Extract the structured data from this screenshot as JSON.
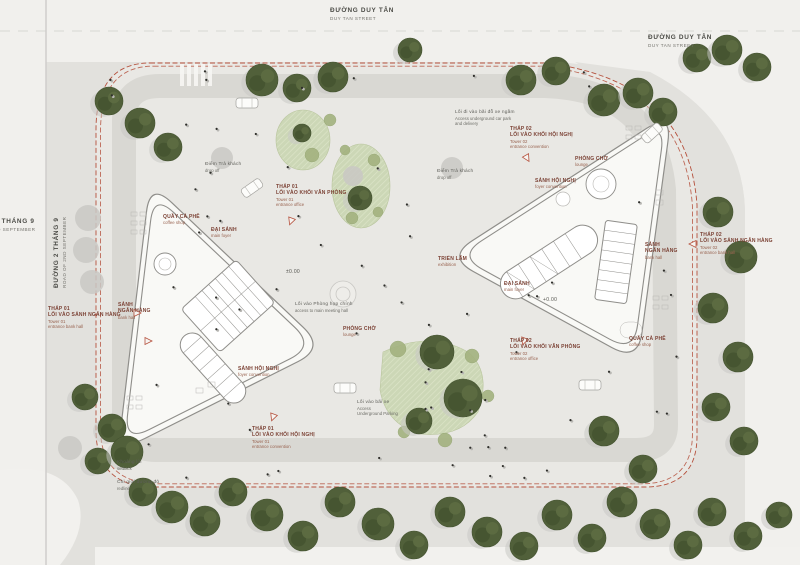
{
  "title": "site-master-plan",
  "colors": {
    "street": "#f1f0ed",
    "sidewalk": "#e2e1dd",
    "site": "#e9e8e4",
    "ring_road": "#d9d8d3",
    "building_fill": "#f9f9f6",
    "building_stroke": "#8f8e8a",
    "redline": "#b5503c",
    "tree": "#51603a",
    "tree_dark": "#43522f",
    "tree_light": "#5d6d42",
    "tree_shadow": "#c9c8c4",
    "patch": "#ccd7b6",
    "shrub": "#a3b27f",
    "text_maroon": "#7b4134",
    "text_gray": "#5f5f5a"
  },
  "annotations": [
    {
      "id": "street-top",
      "type": "street",
      "x": 330,
      "y": 7,
      "vn": 1,
      "lines": [
        "ĐƯỜNG DUY TÂN",
        "DUY TAN STREET"
      ]
    },
    {
      "id": "street-top-right",
      "type": "street",
      "x": 648,
      "y": 34,
      "vn": 1,
      "lines": [
        "ĐƯỜNG DUY TÂN",
        "DUY TAN STREET"
      ]
    },
    {
      "id": "street-left-outer",
      "type": "street",
      "x": -36,
      "y": 218,
      "vn": 1,
      "lines": [
        "ĐƯỜNG 2 THÁNG 9",
        "ROAD OF 2ND SEPTEMBER"
      ]
    },
    {
      "id": "street-left-rotated",
      "type": "street",
      "rot": true,
      "x": 53,
      "y": 288,
      "vn": 1,
      "lines": [
        "ĐƯỜNG 2 THÁNG 9",
        "ROAD OF 2ND SEPTEMBER"
      ]
    },
    {
      "id": "tower01-bank-entrance",
      "type": "callout",
      "x": 48,
      "y": 306,
      "vn": 2,
      "lines": [
        "THÁP 01",
        "LỐI VÀO SẢNH NGÂN HÀNG",
        "Tower 01",
        "entrance bank hall"
      ]
    },
    {
      "id": "bank-hall-01-label",
      "type": "room",
      "x": 118,
      "y": 302,
      "vn": 2,
      "lines": [
        "SẢNH",
        "NGÂN HÀNG",
        "bank hall"
      ]
    },
    {
      "id": "coffee-shop-01",
      "type": "room",
      "x": 163,
      "y": 214,
      "vn": 1,
      "lines": [
        "QUẦY CÀ PHÊ",
        "coffee shop"
      ]
    },
    {
      "id": "main-foyer-01",
      "type": "room",
      "x": 211,
      "y": 227,
      "vn": 1,
      "lines": [
        "ĐẠI SẢNH",
        "main foyer"
      ]
    },
    {
      "id": "tower01-office-entrance",
      "type": "callout",
      "x": 276,
      "y": 184,
      "vn": 2,
      "lines": [
        "THÁP 01",
        "LỐI VÀO KHỐI VĂN PHÒNG",
        "Tower 01",
        "entrance office"
      ]
    },
    {
      "id": "dropoff-01",
      "type": "note",
      "x": 205,
      "y": 162,
      "vn": 1,
      "lines": [
        "Điểm Trả khách",
        "drop off"
      ]
    },
    {
      "id": "dropoff-02",
      "type": "note",
      "x": 437,
      "y": 169,
      "vn": 1,
      "lines": [
        "Điểm Trả khách",
        "drop off"
      ]
    },
    {
      "id": "underground-access-north",
      "type": "note",
      "x": 455,
      "y": 110,
      "vn": 1,
      "lines": [
        "Lối đi vào bãi đỗ xe ngầm",
        "Access underground car park",
        "and delivery"
      ]
    },
    {
      "id": "tower02-convention-entrance",
      "type": "callout",
      "x": 510,
      "y": 126,
      "vn": 2,
      "lines": [
        "THÁP 02",
        "LỐI VÀO KHỐI HỘI NGHỊ",
        "Tower 02",
        "entrance convention"
      ]
    },
    {
      "id": "lounge-02",
      "type": "room",
      "x": 575,
      "y": 156,
      "vn": 1,
      "lines": [
        "PHÒNG CHỜ",
        "lounge"
      ]
    },
    {
      "id": "convention-foyer-02",
      "type": "room",
      "x": 535,
      "y": 178,
      "vn": 1,
      "lines": [
        "SẢNH HỘI NGHỊ",
        "foyer convention"
      ]
    },
    {
      "id": "bank-hall-02-label",
      "type": "room",
      "x": 645,
      "y": 242,
      "vn": 2,
      "lines": [
        "SẢNH",
        "NGÂN HÀNG",
        "bank hall"
      ]
    },
    {
      "id": "tower02-bank-entrance",
      "type": "callout",
      "x": 700,
      "y": 232,
      "vn": 2,
      "lines": [
        "THÁP 02",
        "LỐI VÀO SẢNH NGÂN HÀNG",
        "Tower 02",
        "entrance bank hall"
      ]
    },
    {
      "id": "exhibition-label",
      "type": "room",
      "x": 438,
      "y": 256,
      "vn": 1,
      "lines": [
        "TRIỂN LÃM",
        "exhibition"
      ]
    },
    {
      "id": "main-foyer-02",
      "type": "room",
      "x": 504,
      "y": 281,
      "vn": 1,
      "lines": [
        "ĐẠI SẢNH",
        "main foyer"
      ]
    },
    {
      "id": "level-02",
      "type": "level",
      "x": 543,
      "y": 297,
      "vn": 1,
      "lines": [
        "+0.00"
      ]
    },
    {
      "id": "level-01",
      "type": "level",
      "x": 286,
      "y": 269,
      "vn": 1,
      "lines": [
        "±0.00"
      ]
    },
    {
      "id": "meeting-hall-access",
      "type": "note",
      "x": 295,
      "y": 302,
      "vn": 1,
      "lines": [
        "Lối vào Phòng họp chính",
        "access to main meeting hall"
      ]
    },
    {
      "id": "lounge-01",
      "type": "room",
      "x": 343,
      "y": 326,
      "vn": 1,
      "lines": [
        "PHÒNG CHỜ",
        "lounge"
      ]
    },
    {
      "id": "tower02-office-entrance",
      "type": "callout",
      "x": 510,
      "y": 338,
      "vn": 2,
      "lines": [
        "THÁP 02",
        "LỐI VÀO KHỐI VĂN PHÒNG",
        "Tower 02",
        "entrance office"
      ]
    },
    {
      "id": "coffee-shop-02",
      "type": "room",
      "x": 629,
      "y": 336,
      "vn": 1,
      "lines": [
        "QUẦY CÀ PHÊ",
        "coffee shop"
      ]
    },
    {
      "id": "convention-foyer-01",
      "type": "room",
      "x": 238,
      "y": 366,
      "vn": 1,
      "lines": [
        "SẢNH HỘI NGHỊ",
        "foyer convention"
      ]
    },
    {
      "id": "tower01-convention-entrance",
      "type": "callout",
      "x": 252,
      "y": 426,
      "vn": 2,
      "lines": [
        "THÁP 01",
        "LỐI VÀO KHỐI HỘI NGHỊ",
        "Tower 01",
        "entrance convention"
      ]
    },
    {
      "id": "parking-access-south",
      "type": "note",
      "x": 357,
      "y": 400,
      "vn": 1,
      "lines": [
        "Lối vào bãi xe",
        "Access",
        "Underground Parking"
      ]
    },
    {
      "id": "setback-label",
      "type": "note",
      "x": 117,
      "y": 460,
      "vn": 1,
      "lines": [
        "Khoảng lùi",
        "setback"
      ]
    },
    {
      "id": "redline-label",
      "type": "note",
      "x": 117,
      "y": 480,
      "vn": 1,
      "lines": [
        "Chỉ giới đường đỏ",
        "redline"
      ]
    }
  ],
  "trees": [
    [
      262,
      80,
      16
    ],
    [
      297,
      88,
      14
    ],
    [
      333,
      77,
      15
    ],
    [
      410,
      50,
      12
    ],
    [
      521,
      80,
      15
    ],
    [
      556,
      71,
      14
    ],
    [
      604,
      100,
      16
    ],
    [
      638,
      93,
      15
    ],
    [
      663,
      112,
      14
    ],
    [
      697,
      58,
      14
    ],
    [
      727,
      50,
      15
    ],
    [
      757,
      67,
      14
    ],
    [
      718,
      212,
      15
    ],
    [
      741,
      257,
      16
    ],
    [
      713,
      308,
      15
    ],
    [
      738,
      357,
      15
    ],
    [
      716,
      407,
      14
    ],
    [
      744,
      441,
      14
    ],
    [
      143,
      492,
      14
    ],
    [
      172,
      507,
      16
    ],
    [
      205,
      521,
      15
    ],
    [
      233,
      492,
      14
    ],
    [
      267,
      515,
      16
    ],
    [
      303,
      536,
      15
    ],
    [
      340,
      502,
      15
    ],
    [
      378,
      524,
      16
    ],
    [
      414,
      545,
      14
    ],
    [
      450,
      512,
      15
    ],
    [
      487,
      532,
      15
    ],
    [
      524,
      546,
      14
    ],
    [
      557,
      515,
      15
    ],
    [
      592,
      538,
      14
    ],
    [
      622,
      502,
      15
    ],
    [
      655,
      524,
      15
    ],
    [
      688,
      545,
      14
    ],
    [
      712,
      512,
      14
    ],
    [
      748,
      536,
      14
    ],
    [
      779,
      515,
      13
    ],
    [
      109,
      101,
      14
    ],
    [
      140,
      123,
      15
    ],
    [
      168,
      147,
      14
    ],
    [
      85,
      397,
      13
    ],
    [
      112,
      428,
      14
    ],
    [
      98,
      461,
      13
    ],
    [
      127,
      452,
      16
    ],
    [
      437,
      352,
      17
    ],
    [
      463,
      398,
      19
    ],
    [
      419,
      421,
      13
    ],
    [
      604,
      431,
      15
    ],
    [
      643,
      469,
      14
    ],
    [
      360,
      198,
      12
    ],
    [
      302,
      133,
      9
    ]
  ],
  "gray_blobs": [
    [
      88,
      218,
      13
    ],
    [
      86,
      250,
      13
    ],
    [
      92,
      282,
      12
    ],
    [
      70,
      448,
      12
    ],
    [
      222,
      158,
      11
    ],
    [
      452,
      168,
      11
    ],
    [
      353,
      176,
      10
    ]
  ],
  "shrubs": [
    [
      398,
      349,
      8
    ],
    [
      472,
      356,
      7
    ],
    [
      488,
      396,
      6
    ],
    [
      404,
      432,
      6
    ],
    [
      445,
      440,
      7
    ],
    [
      330,
      120,
      6
    ],
    [
      312,
      155,
      7
    ],
    [
      345,
      150,
      5
    ],
    [
      374,
      160,
      6
    ],
    [
      352,
      218,
      6
    ],
    [
      378,
      212,
      5
    ]
  ],
  "cars": [
    [
      247,
      103,
      0
    ],
    [
      252,
      188,
      -35
    ],
    [
      345,
      388,
      0
    ],
    [
      590,
      385,
      0
    ],
    [
      652,
      133,
      -42
    ]
  ],
  "entry_markers": [
    [
      137,
      313,
      90
    ],
    [
      291,
      221,
      200
    ],
    [
      527,
      158,
      150
    ],
    [
      693,
      244,
      270
    ],
    [
      524,
      341,
      200
    ],
    [
      273,
      417,
      200
    ],
    [
      148,
      341,
      90
    ]
  ]
}
